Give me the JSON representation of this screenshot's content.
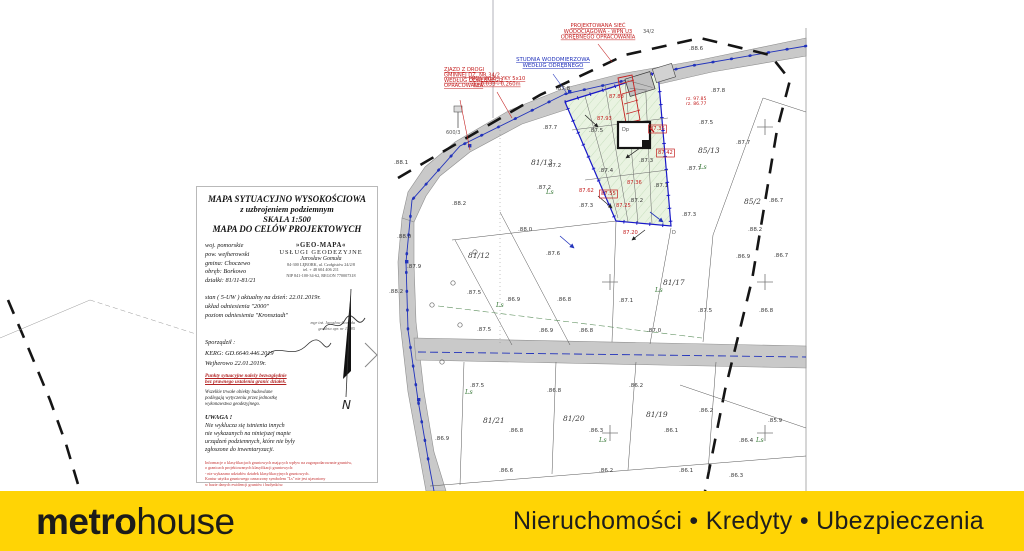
{
  "footer": {
    "logo_metro": "metr",
    "logo_o": "o",
    "logo_house": "house",
    "tagline": "Nieruchomości • Kredyty • Ubezpieczenia",
    "background": "#ffd405"
  },
  "title_block": {
    "title_lines": [
      "MAPA SYTUACYJNO WYSOKOŚCIOWA",
      "z uzbrojeniem podziemnym",
      "SKALA 1:500",
      "MAPA DO CELÓW PROJEKTOWYCH"
    ],
    "location": [
      "woj. pomorskie",
      "pow. wejherowski",
      "gmina: Choczewo",
      "obręb: Borkowo",
      "działki: 81/11-81/21"
    ],
    "company": [
      "»GEO-MAPA«",
      "USŁUGI GEODEZYJNE",
      "Jarosław Gomuła",
      "84-300 LĘBORK, ul. Czołgistów 24/2/8",
      "tel. + 48 604 406 211",
      "NIP 841-100-34-62, REGON 770007318"
    ],
    "status_lines": [
      "stan ( 5-UW ) aktualny na dzień: 22.01.2019r.",
      "układ odniesienia \"2000\"",
      "poziom odniesienia \"Kronsztadt\""
    ],
    "signature": [
      "mgr inż. Jarosław Gomuła",
      "geodeta upr. nr 11285"
    ],
    "prepared_label": "Sporządził :",
    "kerg": "KERG: GD.6640.446.2019",
    "place_date": "Wejherowo 22.01.2019r.",
    "red_note": [
      "Punkty sytuacyjne należy bezwzględnie",
      "bez prawnego ustalenia granic działek."
    ],
    "black_note": [
      "Wszelkie trwałe obiekty budowlane",
      "podlegają wytyczeniu przez jednostkę",
      "wykonawstwa geodezyjnego."
    ],
    "warning_title": "UWAGA !",
    "warning_lines": [
      "Nie wyklucza się istnienia innych",
      "nie wykazanych na niniejszej mapie",
      "urządzeń podziemnych, które nie były",
      "zgłoszone do inwentaryzacji."
    ],
    "red_small_lines": [
      "Informacje o klasyfikacjach gruntowych mających wpływ na zagospodarowanie gruntów,",
      "o granicach projektowanych klasyfikacji gruntowych:",
      "- nie wykazano udziałów działek klasyfikacyjnych gruntowych.",
      "Kontur użytku gruntowego oznaczony symbolem \"Ls\" nie jest ujawniony",
      "w bazie danych ewidencji gruntów i budynków."
    ],
    "red_foot_lines": [
      "W zakresie opracowania brak",
      "projektowanych sieci lub przyłączy.",
      "Wejherowo 22.01.2019r."
    ],
    "north_label": "N"
  },
  "map": {
    "labels": [
      {
        "x": 483,
        "y": 423,
        "t": "81/21",
        "c": "p"
      },
      {
        "x": 563,
        "y": 421,
        "t": "81/20",
        "c": "p"
      },
      {
        "x": 646,
        "y": 417,
        "t": "81/19",
        "c": "p"
      },
      {
        "x": 663,
        "y": 285,
        "t": "81/17",
        "c": "p"
      },
      {
        "x": 531,
        "y": 165,
        "t": "81/13",
        "c": "p"
      },
      {
        "x": 468,
        "y": 258,
        "t": "81/12",
        "c": "p"
      },
      {
        "x": 698,
        "y": 153,
        "t": "85/13",
        "c": "p"
      },
      {
        "x": 744,
        "y": 204,
        "t": "85/2",
        "c": "p"
      },
      {
        "x": 643,
        "y": 33,
        "t": "34/2",
        "c": "g"
      },
      {
        "x": 446,
        "y": 134,
        "t": "600/3",
        "c": "g"
      },
      {
        "x": 622,
        "y": 131,
        "t": "Dp",
        "c": "g"
      },
      {
        "x": 672,
        "y": 234,
        "t": "D",
        "c": "g"
      },
      {
        "x": 556,
        "y": 90,
        "t": ".87.8",
        "c": "e"
      },
      {
        "x": 543,
        "y": 129,
        "t": ".87.7",
        "c": "e"
      },
      {
        "x": 547,
        "y": 167,
        "t": ".87.2",
        "c": "e"
      },
      {
        "x": 537,
        "y": 189,
        "t": ".87.2",
        "c": "e"
      },
      {
        "x": 394,
        "y": 164,
        "t": ".88.1",
        "c": "e"
      },
      {
        "x": 389,
        "y": 293,
        "t": ".88.2",
        "c": "e"
      },
      {
        "x": 407,
        "y": 268,
        "t": ".87.9",
        "c": "e"
      },
      {
        "x": 397,
        "y": 238,
        "t": ".88.0",
        "c": "e"
      },
      {
        "x": 452,
        "y": 205,
        "t": ".88.2",
        "c": "e"
      },
      {
        "x": 467,
        "y": 294,
        "t": ".87.5",
        "c": "e"
      },
      {
        "x": 506,
        "y": 301,
        "t": ".86.9",
        "c": "e"
      },
      {
        "x": 518,
        "y": 231,
        "t": ".88.0",
        "c": "e"
      },
      {
        "x": 546,
        "y": 255,
        "t": ".87.6",
        "c": "e"
      },
      {
        "x": 557,
        "y": 301,
        "t": ".86.8",
        "c": "e"
      },
      {
        "x": 477,
        "y": 331,
        "t": ".87.5",
        "c": "e"
      },
      {
        "x": 539,
        "y": 332,
        "t": ".86.9",
        "c": "e"
      },
      {
        "x": 689,
        "y": 50,
        "t": ".88.6",
        "c": "e"
      },
      {
        "x": 711,
        "y": 92,
        "t": ".87.8",
        "c": "e"
      },
      {
        "x": 699,
        "y": 124,
        "t": ".87.5",
        "c": "e"
      },
      {
        "x": 736,
        "y": 144,
        "t": ".87.7",
        "c": "e"
      },
      {
        "x": 687,
        "y": 170,
        "t": ".87.7",
        "c": "e"
      },
      {
        "x": 682,
        "y": 216,
        "t": ".87.3",
        "c": "e"
      },
      {
        "x": 748,
        "y": 231,
        "t": ".88.2",
        "c": "e"
      },
      {
        "x": 736,
        "y": 258,
        "t": ".86.9",
        "c": "e"
      },
      {
        "x": 769,
        "y": 202,
        "t": ".86.7",
        "c": "e"
      },
      {
        "x": 774,
        "y": 257,
        "t": ".86.7",
        "c": "e"
      },
      {
        "x": 759,
        "y": 312,
        "t": ".86.8",
        "c": "e"
      },
      {
        "x": 698,
        "y": 312,
        "t": ".87.5",
        "c": "e"
      },
      {
        "x": 647,
        "y": 332,
        "t": ".87.0",
        "c": "e"
      },
      {
        "x": 619,
        "y": 302,
        "t": ".87.1",
        "c": "e"
      },
      {
        "x": 579,
        "y": 332,
        "t": ".86.8",
        "c": "e"
      },
      {
        "x": 470,
        "y": 387,
        "t": ".87.5",
        "c": "e"
      },
      {
        "x": 509,
        "y": 432,
        "t": ".86.8",
        "c": "e"
      },
      {
        "x": 547,
        "y": 392,
        "t": ".86.8",
        "c": "e"
      },
      {
        "x": 589,
        "y": 432,
        "t": ".86.3",
        "c": "e"
      },
      {
        "x": 629,
        "y": 387,
        "t": ".86.2",
        "c": "e"
      },
      {
        "x": 664,
        "y": 432,
        "t": ".86.1",
        "c": "e"
      },
      {
        "x": 699,
        "y": 412,
        "t": ".86.2",
        "c": "e"
      },
      {
        "x": 739,
        "y": 442,
        "t": ".86.4",
        "c": "e"
      },
      {
        "x": 768,
        "y": 422,
        "t": ".85.9",
        "c": "e"
      },
      {
        "x": 599,
        "y": 472,
        "t": ".86.2",
        "c": "e"
      },
      {
        "x": 679,
        "y": 472,
        "t": ".86.1",
        "c": "e"
      },
      {
        "x": 729,
        "y": 477,
        "t": ".86.3",
        "c": "e"
      },
      {
        "x": 499,
        "y": 472,
        "t": ".86.6",
        "c": "e"
      },
      {
        "x": 435,
        "y": 440,
        "t": ".86.9",
        "c": "e"
      },
      {
        "x": 589,
        "y": 132,
        "t": ".87.5",
        "c": "e"
      },
      {
        "x": 639,
        "y": 162,
        "t": ".87.3",
        "c": "e"
      },
      {
        "x": 599,
        "y": 172,
        "t": ".87.4",
        "c": "e"
      },
      {
        "x": 629,
        "y": 202,
        "t": ".87.2",
        "c": "e"
      },
      {
        "x": 579,
        "y": 207,
        "t": ".87.3",
        "c": "e"
      },
      {
        "x": 654,
        "y": 187,
        "t": ".87.1",
        "c": "e"
      },
      {
        "x": 597,
        "y": 120,
        "t": "87.93",
        "c": "er"
      },
      {
        "x": 579,
        "y": 192,
        "t": "87.62",
        "c": "er"
      },
      {
        "x": 627,
        "y": 184,
        "t": "87.36",
        "c": "er"
      },
      {
        "x": 616,
        "y": 207,
        "t": "87.25",
        "c": "er"
      },
      {
        "x": 623,
        "y": 234,
        "t": "87.20",
        "c": "er"
      },
      {
        "x": 609,
        "y": 98,
        "t": "87.88",
        "c": "er"
      },
      {
        "x": 650,
        "y": 130,
        "t": "87.35",
        "c": "erb"
      },
      {
        "x": 658,
        "y": 154,
        "t": "87.42",
        "c": "erb"
      },
      {
        "x": 601,
        "y": 195,
        "t": "87.55",
        "c": "erb"
      },
      {
        "x": 496,
        "y": 307,
        "t": "Ls",
        "c": "ls"
      },
      {
        "x": 546,
        "y": 194,
        "t": "Ls",
        "c": "ls"
      },
      {
        "x": 655,
        "y": 292,
        "t": "Ls",
        "c": "ls"
      },
      {
        "x": 699,
        "y": 169,
        "t": "Ls",
        "c": "ls"
      },
      {
        "x": 599,
        "y": 442,
        "t": "Ls",
        "c": "ls"
      },
      {
        "x": 756,
        "y": 442,
        "t": "Ls",
        "c": "ls"
      },
      {
        "x": 465,
        "y": 394,
        "t": "Ls",
        "c": "ls"
      }
    ],
    "annotations": [
      {
        "x": 598,
        "y": 27,
        "anchor": "middle",
        "c": "an-red",
        "lh": 5.8,
        "lines": [
          "PROJEKTOWANA SIEĆ",
          "WODOCIĄGOWA - WPN U3",
          "ODRĘBNEGO OPRACOWANIA"
        ]
      },
      {
        "x": 553,
        "y": 61,
        "anchor": "middle",
        "c": "an-blue",
        "lh": 6,
        "lines": [
          "STUDNIA WODOMIERZOWA",
          "WEDŁUG ODRĘBNEGO"
        ]
      },
      {
        "x": 497,
        "y": 80,
        "anchor": "middle",
        "c": "an-red",
        "lh": 5.6,
        "lines": [
          "PROJ. WLZ - YKY 5x10",
          "L=0,033 - 0,260m"
        ]
      },
      {
        "x": 444,
        "y": 71,
        "anchor": "start",
        "c": "an-red",
        "lh": 5.4,
        "lines": [
          "ZJAZD Z DROGI",
          "GMINNEJ DZ. NR 34/2",
          "WEDŁUG ODRĘBNEGO",
          "OPRACOWANIA"
        ]
      },
      {
        "x": 686,
        "y": 100,
        "anchor": "start",
        "c": "an-red-sm",
        "lh": 5,
        "lines": [
          "rz. 97.85",
          "rz. 86.77"
        ]
      }
    ]
  }
}
